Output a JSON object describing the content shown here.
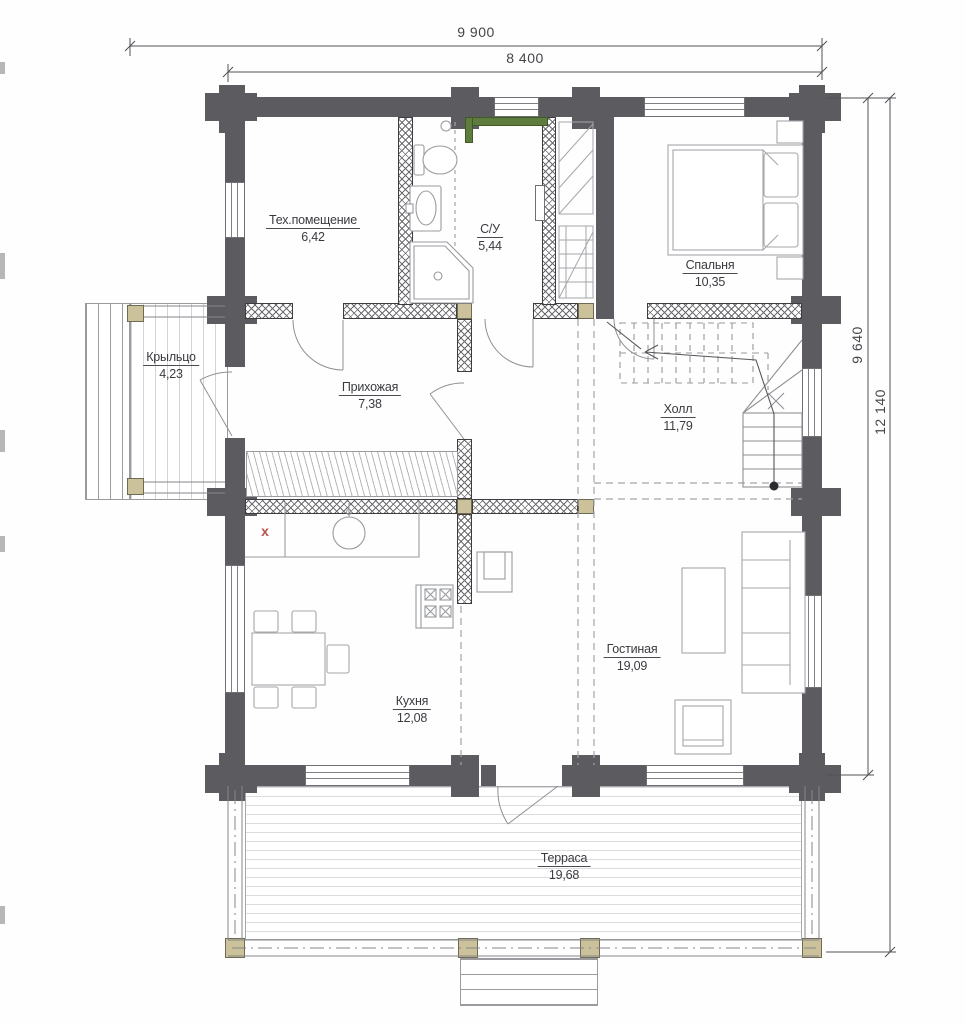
{
  "title": "Floor plan — first floor",
  "dimensions": {
    "top_overall": "9 900",
    "top_main": "8 400",
    "right_main": "9 640",
    "right_overall": "12 140"
  },
  "rooms": {
    "tech": {
      "name": "Тех.помещение",
      "area": "6,42"
    },
    "bathroom": {
      "name": "С/У",
      "area": "5,44"
    },
    "bedroom": {
      "name": "Спальня",
      "area": "10,35"
    },
    "porch": {
      "name": "Крыльцо",
      "area": "4,23"
    },
    "hallway": {
      "name": "Прихожая",
      "area": "7,38"
    },
    "hall": {
      "name": "Холл",
      "area": "11,79"
    },
    "kitchen": {
      "name": "Кухня",
      "area": "12,08"
    },
    "living": {
      "name": "Гостиная",
      "area": "19,09"
    },
    "terrace": {
      "name": "Терраса",
      "area": "19,68"
    }
  },
  "marks": {
    "boiler_mark": "x"
  },
  "colors": {
    "log_wall": "#5c5c60",
    "frame_wall_hatch": "#6c6c70",
    "timber_post": "#cbc29b",
    "green_partition": "#5e7c3e",
    "text": "#3a3b40",
    "thin_lines": "#a6a7ab",
    "mark_red": "#b5544b"
  }
}
